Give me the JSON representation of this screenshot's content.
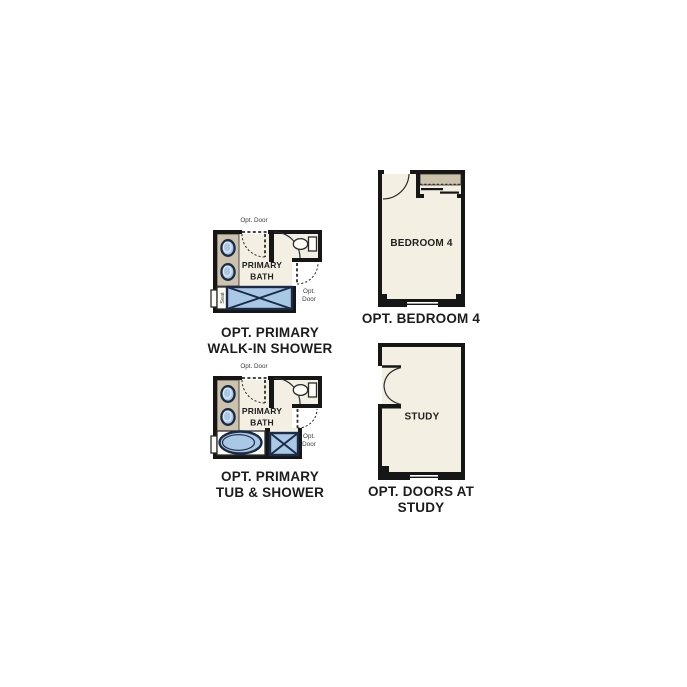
{
  "colors": {
    "wall": "#161616",
    "room_fill": "#f4efe3",
    "counter_fill": "#cdc3ac",
    "fixture_blue": "#a9c8e6",
    "fixture_stroke": "#1c2b45",
    "caption_text": "#1c1c1c"
  },
  "plans": {
    "walk_in_shower": {
      "caption": [
        "OPT. PRIMARY",
        "WALK-IN SHOWER"
      ],
      "room_label": [
        "PRIMARY",
        "BATH"
      ],
      "opt_door_top": "Opt. Door",
      "opt_door_side": [
        "Opt.",
        "Door"
      ],
      "seat_label": "Seat"
    },
    "bedroom4": {
      "caption": "OPT. BEDROOM 4",
      "room_label": "BEDROOM 4"
    },
    "tub_shower": {
      "caption": [
        "OPT. PRIMARY",
        "TUB & SHOWER"
      ],
      "room_label": [
        "PRIMARY",
        "BATH"
      ],
      "opt_door_top": "Opt. Door",
      "opt_door_side": [
        "Opt.",
        "Door"
      ]
    },
    "study": {
      "caption": [
        "OPT. DOORS AT",
        "STUDY"
      ],
      "room_label": "STUDY"
    }
  }
}
